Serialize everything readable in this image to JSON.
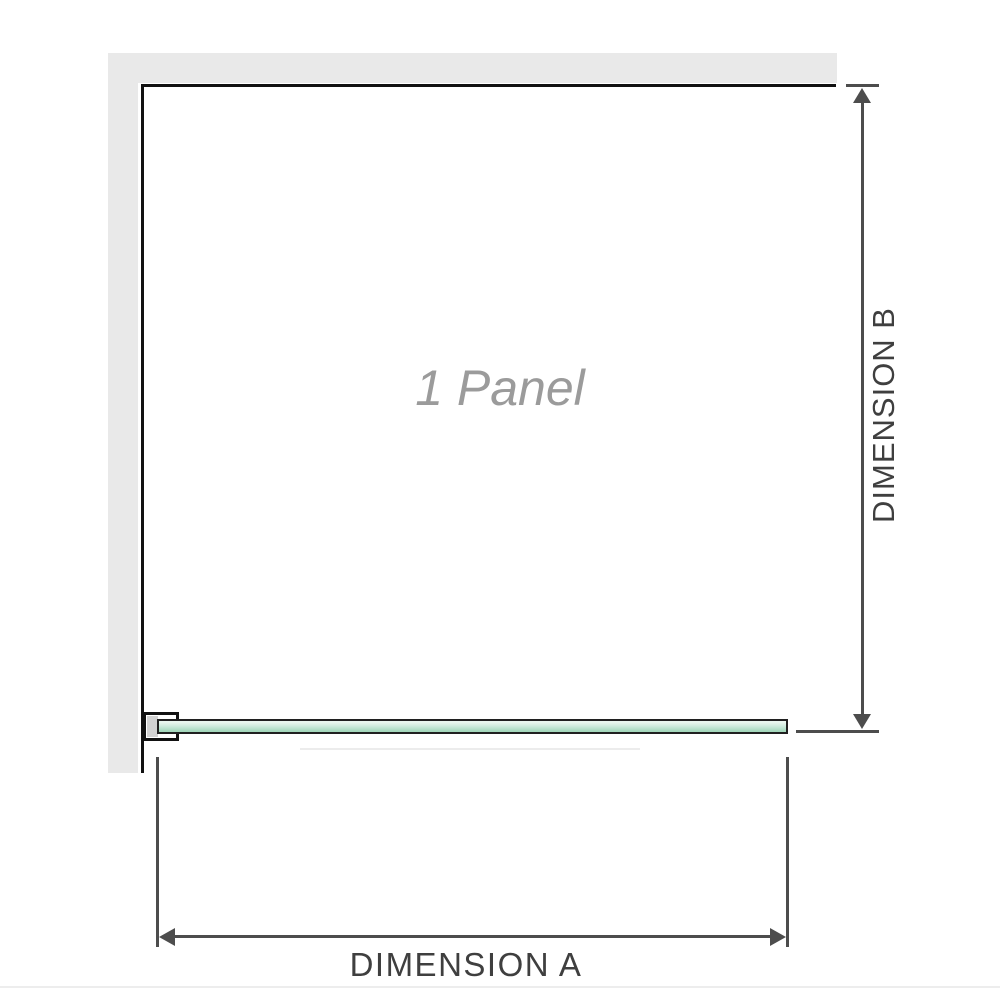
{
  "diagram": {
    "panel_label": "1 Panel",
    "dimension_a_label": "DIMENSION A",
    "dimension_b_label": "DIMENSION B"
  },
  "colors": {
    "background": "#ffffff",
    "wall": "#e9e9e9",
    "outline": "#111111",
    "dim_line": "#4d4d4d",
    "dim_text": "#3f3f3f",
    "panel_text": "#9b9b9b",
    "glass_edge": "#202020",
    "glass_light": "#e9f6ef",
    "glass_mid": "#cdeadc",
    "glass_deep": "#a4d8bc",
    "clamp_inner": "#d2d2d2"
  }
}
